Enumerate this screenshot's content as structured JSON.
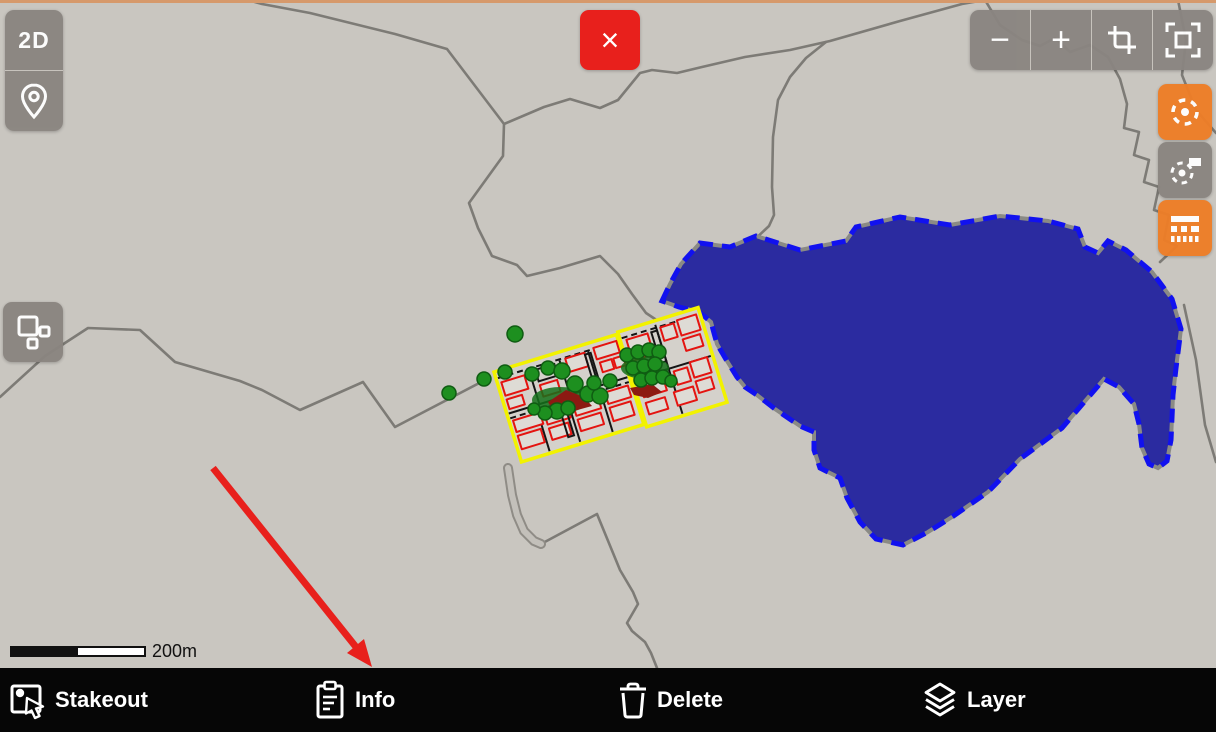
{
  "colors": {
    "map_bg": "#c9c6c0",
    "top_strip": "#d6996b",
    "button_gray": "#8a8580",
    "accent_orange": "#ee7e27",
    "close_red": "#e8201c",
    "lake_fill": "#2b2ba0",
    "lake_dash": "#1111ef",
    "road": "#7d7b76",
    "urban_yellow": "#f2f200",
    "building_red": "#e41410",
    "tree_green": "#1d8f1f",
    "arrow_red": "#e8201c",
    "bar_bg": "#060606"
  },
  "map": {
    "scale_bar_label": "200m",
    "features": {
      "lake": "selected-polygon-blue-dashed",
      "urban_blocks": "yellow-outlined-parcels-with-red-buildings",
      "trees": "green-point-markers",
      "roads": "gray-polylines"
    }
  },
  "top_left_controls": {
    "view_mode_label": "2D",
    "location_icon": "location-pin-icon",
    "blocks_icon": "blocks-icon"
  },
  "top_right_controls": {
    "zoom_out_glyph": "−",
    "zoom_in_glyph": "+",
    "crop_icon": "crop-icon",
    "fullscreen_icon": "fullscreen-frame-icon"
  },
  "close_button": {
    "glyph": "×"
  },
  "right_controls": {
    "locate_icon": "locate-crosshair-icon",
    "locate_points_icon": "crosshair-with-rect-icon",
    "panel_icon": "toolbar-bars-icon"
  },
  "bottom_bar": {
    "items": [
      {
        "label": "Stakeout",
        "icon": "stakeout-icon"
      },
      {
        "label": "Info",
        "icon": "info-clipboard-icon"
      },
      {
        "label": "Delete",
        "icon": "trash-icon"
      },
      {
        "label": "Layer",
        "icon": "layers-icon"
      }
    ]
  },
  "annotation": {
    "arrow_points_to": "Info"
  }
}
